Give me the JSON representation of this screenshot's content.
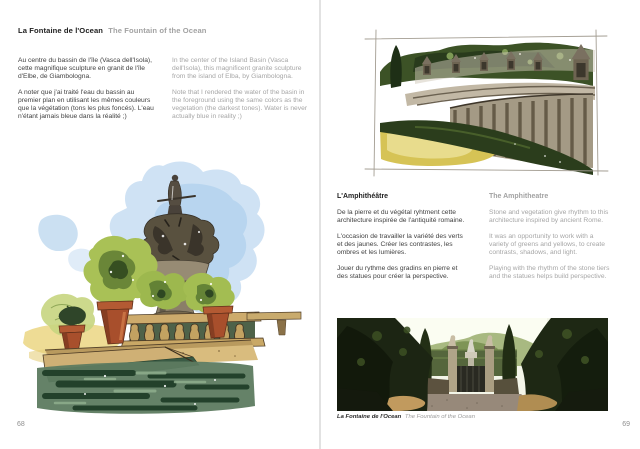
{
  "left_page": {
    "title_fr": "La Fontaine de l'Ocean",
    "title_en": "The Fountain of the Ocean",
    "col_fr": [
      "Au centre du bassin de l'île (Vasca dell'Isola), cette magnifique sculpture en granit de l'île d'Elbe, de Giambologna.",
      "A noter que j'ai traité l'eau du bassin au premier plan en utilisant les mêmes couleurs que la végétation (tons les plus foncés). L'eau n'étant jamais bleue dans la réalité ;)"
    ],
    "col_en": [
      "In the center of the Island Basin (Vasca dell'Isola), this magnificent granite sculpture from the island of Elba, by Giambologna.",
      "Note that I rendered the water of the basin in the foreground using the same colors as the vegetation (the darkest tones). Water is never actually blue in reality ;)"
    ],
    "illustration_description": "Watercolor of the Fountain of the Ocean: dark granite statue on a tiered fountain, potted green shrubs on a stone balustrade, dark green water in the foreground, blue sky wash behind",
    "page_number": "68"
  },
  "right_page": {
    "section_title_fr": "L'Amphithéâtre",
    "section_title_en": "The Amphitheatre",
    "col_fr": [
      "De la pierre et du végétal ryhtment cette architecture inspirée de l'antiquité romaine.",
      "L'occasion de travailler la variété des verts et des jaunes. Créer les contrastes, les ombres et les lumières.",
      "Jouer du rythme des gradins en pierre et des statues pour créer la perspective."
    ],
    "col_en": [
      "Stone and vegetation give rhythm to this architecture inspired by ancient Rome.",
      "It was an opportunity to work with a variety of greens and yellows, to create contrasts, shadows, and light.",
      "Playing with the rhythm of the stone tiers and the statues helps build perspective."
    ],
    "sketch_description": "Watercolor sketch in a pencil frame: curved stone amphitheatre tiers with statues in niches, dark trees behind, yellow-green lawn and dark hedge in front",
    "photo_description": "Photograph of a gravel garden alley flanked by dark trees leading to a gate with the fountain in the distance",
    "caption_fr": "La Fontaine de l'Ocean",
    "caption_en": "The Fountain of the Ocean",
    "page_number": "69"
  },
  "colors": {
    "title_dark": "#1e1e1e",
    "muted_gray": "#a2a2a2",
    "body_text": "#3f3f3f",
    "gutter_line": "#e2e2e2",
    "watercolor_sky": "#bcd7ef",
    "watercolor_green": "#a9c156",
    "watercolor_dark_green": "#31491f",
    "terracotta": "#a84f2c",
    "stone_tan": "#d9bc7e",
    "water_dark": "#23412b",
    "lawn_yellow": "#d6c355"
  }
}
